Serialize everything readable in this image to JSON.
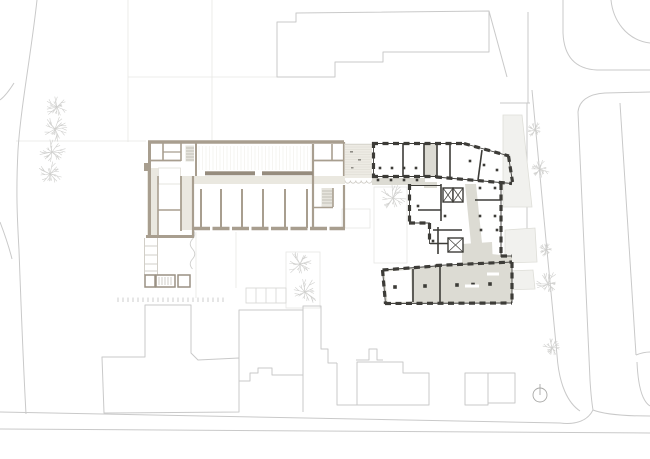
{
  "canvas": {
    "width": 650,
    "height": 459
  },
  "palette": {
    "background": "#ffffff",
    "site_line": "#c9c9c9",
    "faint_line": "#e7e7e5",
    "new_wall": "#a89e8f",
    "new_wall_dark": "#968c7e",
    "existing_wall": "#3d3c38",
    "floor_gray": "#dcdbd3",
    "corridor_beige": "#eae8e0",
    "stair_fill": "#e6e4dd",
    "annex_fill": "#f1f1ee",
    "annex_line": "#deded8",
    "tree_line": "#cfcfcd",
    "hatch_line": "#dcd9d0",
    "north_line": "#a9a9a7"
  },
  "site": {
    "trees": [
      {
        "x": 57,
        "y": 107,
        "r": 12
      },
      {
        "x": 55,
        "y": 129,
        "r": 13
      },
      {
        "x": 52,
        "y": 152,
        "r": 14
      },
      {
        "x": 50,
        "y": 174,
        "r": 13
      },
      {
        "x": 300,
        "y": 264,
        "r": 14
      },
      {
        "x": 305,
        "y": 292,
        "r": 15
      },
      {
        "x": 393,
        "y": 198,
        "r": 14
      },
      {
        "x": 535,
        "y": 130,
        "r": 8
      },
      {
        "x": 540,
        "y": 169,
        "r": 10
      },
      {
        "x": 546,
        "y": 250,
        "r": 9
      },
      {
        "x": 548,
        "y": 284,
        "r": 13
      },
      {
        "x": 552,
        "y": 348,
        "r": 10
      }
    ],
    "parking_ticks": {
      "x_start": 118,
      "x_end": 223,
      "y": 297.5,
      "height": 4.5,
      "count": 22
    },
    "parking_stalls": {
      "x": 246,
      "y": 288,
      "cell_width": 10,
      "cell_height": 15,
      "count": 4
    },
    "sheds": [
      {
        "x": 145,
        "y": 275,
        "w": 10,
        "h": 12,
        "hatched": false
      },
      {
        "x": 156,
        "y": 275,
        "w": 19,
        "h": 12,
        "hatched": true
      },
      {
        "x": 178,
        "y": 275,
        "w": 12,
        "h": 12,
        "hatched": false
      }
    ],
    "north_arrow": {
      "x": 540,
      "y": 395,
      "r": 7
    }
  },
  "new_building": {
    "partitions_x": [
      201,
      221,
      242,
      263,
      285,
      307
    ],
    "hall_stripes": {
      "x1": 199,
      "x2": 312,
      "y1": 146,
      "y2": 170,
      "step": 3.5
    },
    "terrace_hatch": {
      "x1": 345,
      "x2": 372,
      "y1": 147,
      "y2": 176,
      "step": 2.5
    }
  },
  "existing_building": {
    "columns": [
      [
        395,
        287
      ],
      [
        425,
        286
      ],
      [
        457,
        285
      ],
      [
        473,
        284.5
      ],
      [
        490,
        284
      ]
    ],
    "pier_dots": [
      [
        380,
        168
      ],
      [
        392,
        168
      ],
      [
        404,
        168
      ],
      [
        416,
        168
      ],
      [
        470,
        161
      ],
      [
        484,
        165
      ],
      [
        497,
        170
      ],
      [
        480,
        188
      ],
      [
        495,
        188
      ],
      [
        480,
        216
      ],
      [
        495,
        216
      ],
      [
        445,
        216
      ],
      [
        418,
        206
      ],
      [
        433,
        241
      ],
      [
        481,
        230
      ],
      [
        497,
        230
      ],
      [
        378,
        180
      ],
      [
        391,
        180
      ],
      [
        404,
        180
      ],
      [
        417,
        180
      ]
    ],
    "elevators": [
      {
        "x": 443,
        "y": 188,
        "w": 10,
        "h": 14
      },
      {
        "x": 453,
        "y": 188,
        "w": 10,
        "h": 14
      },
      {
        "x": 448,
        "y": 238,
        "w": 15,
        "h": 14
      }
    ]
  }
}
